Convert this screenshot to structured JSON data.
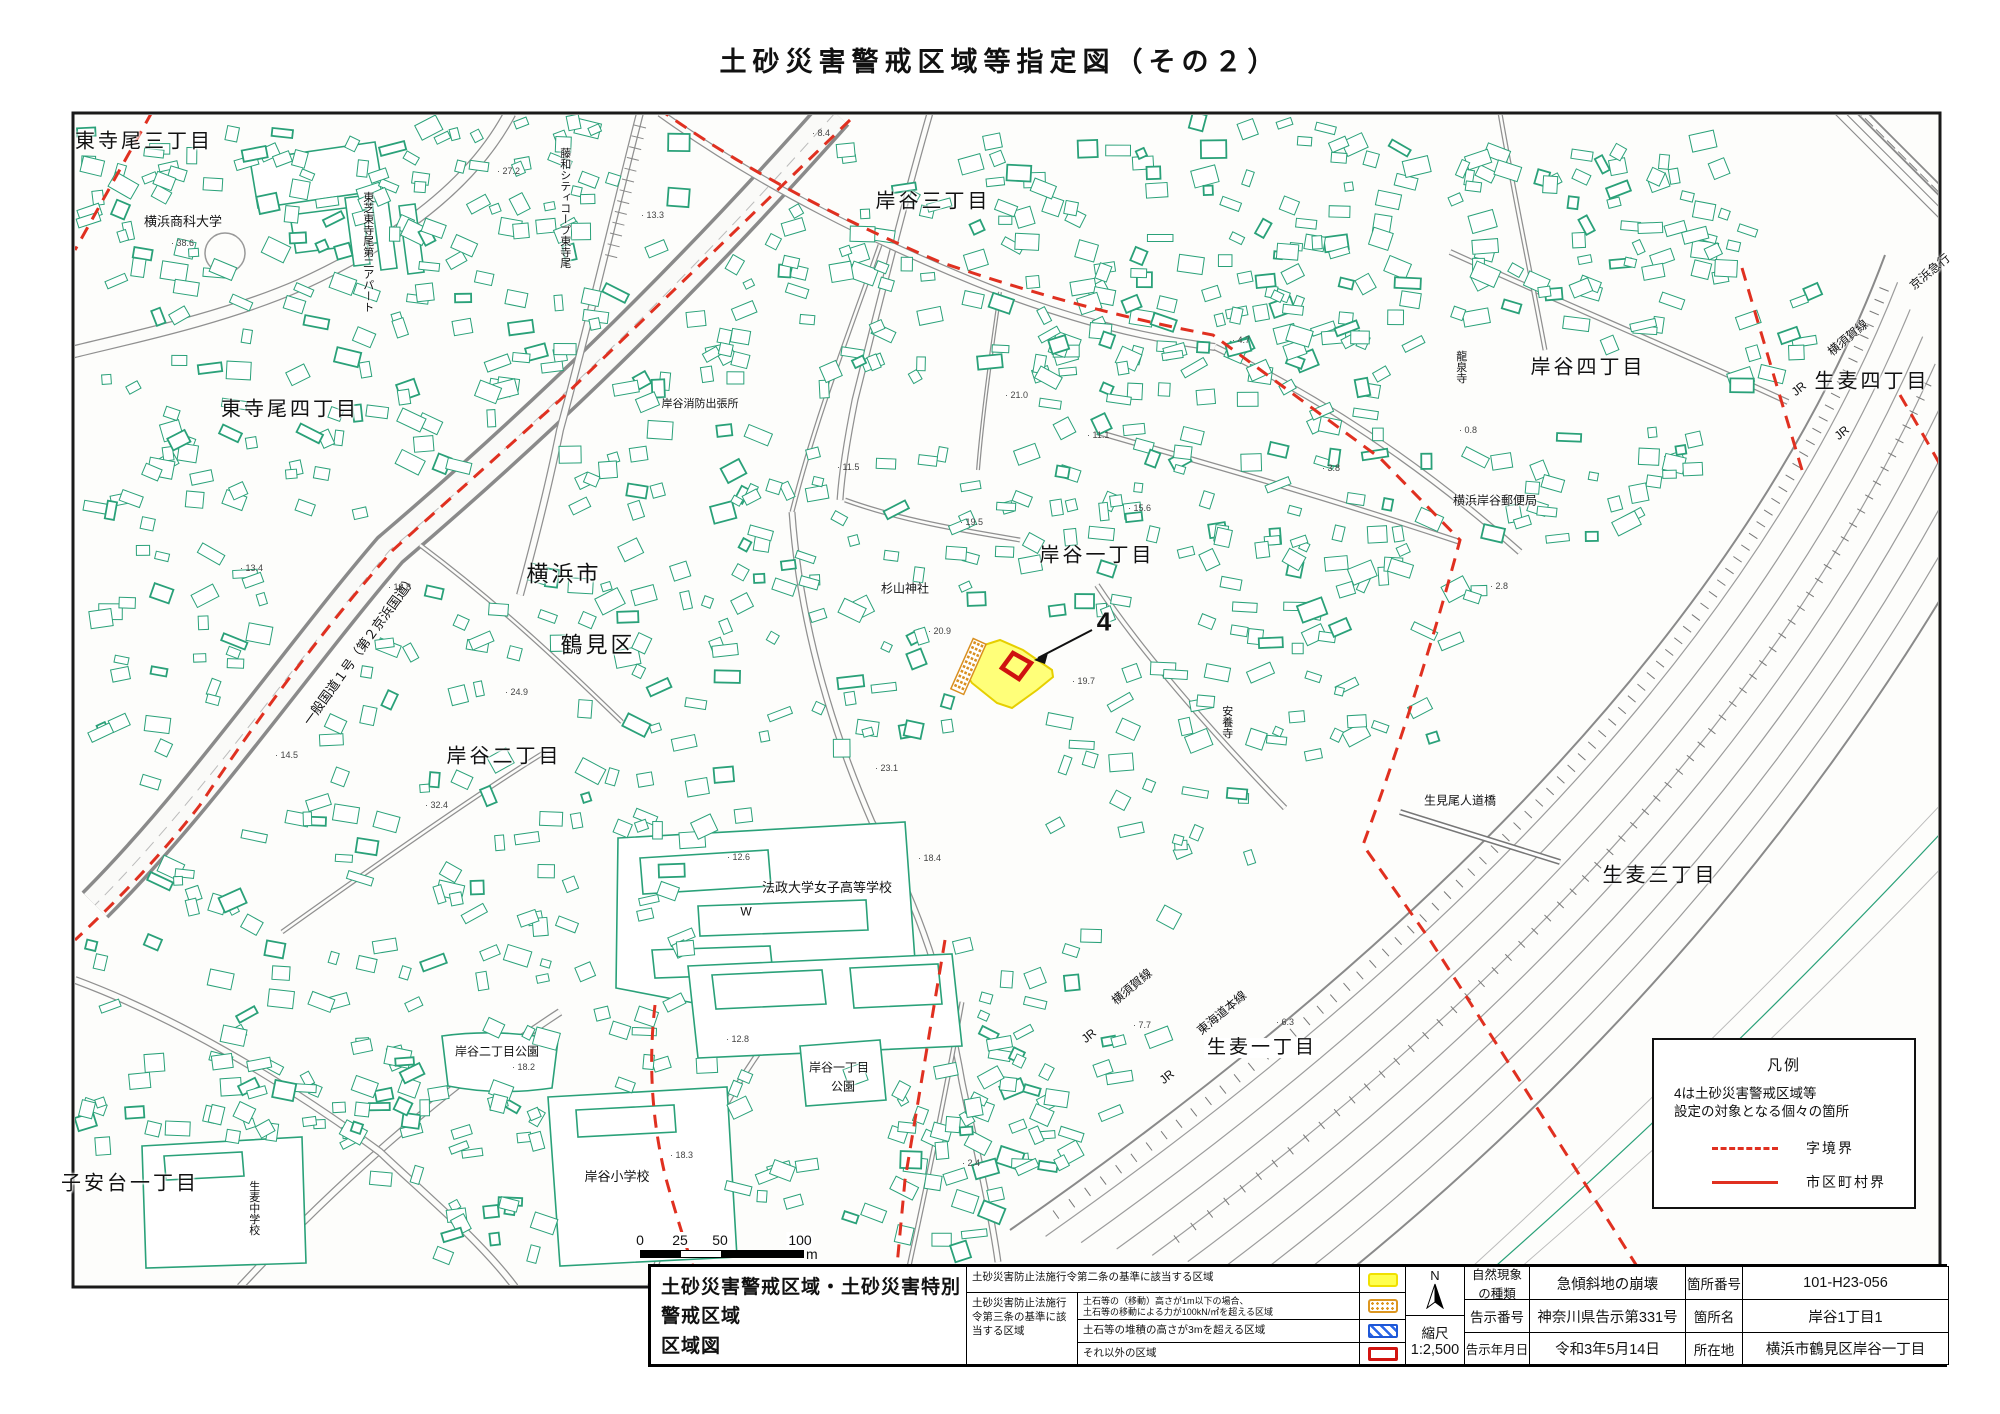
{
  "title": "土砂災害警戒区域等指定図（その２）",
  "legend_box": {
    "title": "凡例",
    "note1": "4は土砂災害警戒区域等",
    "note2": "設定の対象となる個々の箇所",
    "item1": "字境界",
    "item2": "市区町村界"
  },
  "scale_bar": {
    "t0": "0",
    "t1": "25",
    "t2": "50",
    "t3": "100",
    "unit": "m"
  },
  "info_table": {
    "title_line1": "土砂災害警戒区域・土砂災害特別警戒区域",
    "title_line2": "区域図",
    "row1_label": "土砂災害防止法施行令第二条の基準に該当する区域",
    "law3_label": "土砂災害防止法施行令第三条の基準に該当する区域",
    "row2_line1": "土石等の（移動）高さが1m以下の場合、",
    "row2_line2": "土石等の移動による力が100kN/㎡を超える区域",
    "row3_label": "土石等の堆積の高さが3mを超える区域",
    "row4_label": "それ以外の区域",
    "compass": "N",
    "scale_label": "縮尺",
    "scale_value": "1:2,500",
    "h_phenomenon": "自然現象の種類",
    "v_phenomenon": "急傾斜地の崩壊",
    "h_site_no": "箇所番号",
    "v_site_no": "101-H23-056",
    "h_notice_no": "告示番号",
    "v_notice_no": "神奈川県告示第331号",
    "h_site_name": "箇所名",
    "v_site_name": "岸谷1丁目1",
    "h_notice_date": "告示年月日",
    "v_notice_date": "令和3年5月14日",
    "h_location": "所在地",
    "v_location": "横浜市鶴見区岸谷一丁目"
  },
  "map": {
    "marker": {
      "label": "4"
    },
    "labels": [
      {
        "n": "higashiterao-3",
        "t": "東寺尾三丁目",
        "x": 144,
        "y": 142,
        "s": 20,
        "big": true
      },
      {
        "n": "shokadai",
        "t": "横浜商科大学",
        "x": 183,
        "y": 222,
        "s": 13
      },
      {
        "n": "toshiba-apart",
        "t": "東芝東寺尾第二アパート",
        "x": 367,
        "y": 252,
        "s": 11,
        "v": true
      },
      {
        "n": "higashiterao-4",
        "t": "東寺尾四丁目",
        "x": 290,
        "y": 410,
        "s": 20,
        "big": true
      },
      {
        "n": "towa-city-coop",
        "t": "藤和シティコープ東寺尾",
        "x": 564,
        "y": 208,
        "s": 11,
        "v": true
      },
      {
        "n": "kishiya-3",
        "t": "岸谷三丁目",
        "x": 933,
        "y": 202,
        "s": 20,
        "big": true
      },
      {
        "n": "shobo-shutchojo",
        "t": "岸谷消防出張所",
        "x": 700,
        "y": 405,
        "s": 11
      },
      {
        "n": "yokohama-shi",
        "t": "横浜市",
        "x": 564,
        "y": 574,
        "s": 22,
        "big": true
      },
      {
        "n": "tsurumi-ku",
        "t": "鶴見区",
        "x": 598,
        "y": 645,
        "s": 22,
        "big": true
      },
      {
        "n": "kishiya-2",
        "t": "岸谷二丁目",
        "x": 504,
        "y": 757,
        "s": 20,
        "big": true
      },
      {
        "n": "kokudo-1",
        "t": "一般国道１号（第２京浜国道）",
        "x": 360,
        "y": 650,
        "s": 13,
        "r": -54
      },
      {
        "n": "sugiyama-jinja",
        "t": "杉山神社",
        "x": 905,
        "y": 589,
        "s": 12
      },
      {
        "n": "kishiya-1",
        "t": "岸谷一丁目",
        "x": 1097,
        "y": 556,
        "s": 20,
        "big": true
      },
      {
        "n": "anyoji",
        "t": "安養寺",
        "x": 1226,
        "y": 722,
        "s": 11,
        "v": true
      },
      {
        "n": "ryusenji",
        "t": "龍泉寺",
        "x": 1460,
        "y": 367,
        "s": 11,
        "v": true
      },
      {
        "n": "yubinkyoku",
        "t": "横浜岸谷郵便局",
        "x": 1495,
        "y": 501,
        "s": 12
      },
      {
        "n": "kishiya-4",
        "t": "岸谷四丁目",
        "x": 1588,
        "y": 368,
        "s": 20,
        "big": true
      },
      {
        "n": "namamugi-4",
        "t": "生麦四丁目",
        "x": 1872,
        "y": 382,
        "s": 20,
        "big": true
      },
      {
        "n": "yokosuka-line-ne",
        "t": "横須賀線",
        "x": 1848,
        "y": 338,
        "s": 12,
        "r": -40
      },
      {
        "n": "jr-ne-1",
        "t": "JR",
        "x": 1799,
        "y": 389,
        "s": 12,
        "r": -40
      },
      {
        "n": "jr-ne-2",
        "t": "JR",
        "x": 1842,
        "y": 433,
        "s": 12,
        "r": -40
      },
      {
        "n": "keihin-kyuko",
        "t": "京浜急行",
        "x": 1930,
        "y": 272,
        "s": 12,
        "r": -40
      },
      {
        "n": "kishiya2-park",
        "t": "岸谷二丁目公園",
        "x": 497,
        "y": 1052,
        "s": 12
      },
      {
        "n": "kishiya1-park-1",
        "t": "岸谷一丁目",
        "x": 839,
        "y": 1068,
        "s": 12
      },
      {
        "n": "kishiya1-park-2",
        "t": "公園",
        "x": 843,
        "y": 1087,
        "s": 12
      },
      {
        "n": "hosei-school",
        "t": "法政大学女子高等学校",
        "x": 827,
        "y": 888,
        "s": 13
      },
      {
        "n": "w-mark",
        "t": "W",
        "x": 746,
        "y": 912,
        "s": 12
      },
      {
        "n": "kishiya-shogakko",
        "t": "岸谷小学校",
        "x": 617,
        "y": 1177,
        "s": 13
      },
      {
        "n": "namamugi-chugakko",
        "t": "生麦中学校",
        "x": 253,
        "y": 1208,
        "s": 11,
        "v": true
      },
      {
        "n": "koyasudai-1",
        "t": "子安台一丁目",
        "x": 130,
        "y": 1184,
        "s": 20,
        "big": true
      },
      {
        "n": "namamugi-3",
        "t": "生麦三丁目",
        "x": 1660,
        "y": 876,
        "s": 20,
        "big": true
      },
      {
        "n": "namamugi-1",
        "t": "生麦一丁目",
        "x": 1262,
        "y": 1048,
        "s": 19,
        "big": true,
        "bg": true
      },
      {
        "n": "umio-bridge",
        "t": "生見尾人道橋",
        "x": 1460,
        "y": 801,
        "s": 12,
        "bg": true
      },
      {
        "n": "jr-sw-1",
        "t": "JR",
        "x": 1089,
        "y": 1036,
        "s": 12,
        "r": -40
      },
      {
        "n": "yokosuka-line-sw",
        "t": "横須賀線",
        "x": 1132,
        "y": 987,
        "s": 12,
        "r": -40
      },
      {
        "n": "jr-sw-2",
        "t": "JR",
        "x": 1167,
        "y": 1077,
        "s": 12,
        "r": -40
      },
      {
        "n": "tokaido-line",
        "t": "東海道本線",
        "x": 1222,
        "y": 1013,
        "s": 12,
        "r": -40
      }
    ],
    "spots": [
      {
        "t": "38.6",
        "x": 171,
        "y": 243
      },
      {
        "t": "27.2",
        "x": 497,
        "y": 171
      },
      {
        "t": "13.3",
        "x": 641,
        "y": 215
      },
      {
        "t": "8.4",
        "x": 812,
        "y": 133
      },
      {
        "t": "20.9",
        "x": 928,
        "y": 631
      },
      {
        "t": "19.7",
        "x": 1072,
        "y": 681
      },
      {
        "t": "11.5",
        "x": 837,
        "y": 467
      },
      {
        "t": "21.0",
        "x": 1005,
        "y": 395
      },
      {
        "t": "19.5",
        "x": 960,
        "y": 522
      },
      {
        "t": "13.4",
        "x": 240,
        "y": 568
      },
      {
        "t": "12.8",
        "x": 388,
        "y": 587
      },
      {
        "t": "24.9",
        "x": 505,
        "y": 692
      },
      {
        "t": "14.5",
        "x": 275,
        "y": 755
      },
      {
        "t": "32.4",
        "x": 425,
        "y": 805
      },
      {
        "t": "11.1",
        "x": 1087,
        "y": 435
      },
      {
        "t": "15.6",
        "x": 1128,
        "y": 508
      },
      {
        "t": "3.8",
        "x": 1322,
        "y": 468
      },
      {
        "t": "4.7",
        "x": 1232,
        "y": 340
      },
      {
        "t": "0.8",
        "x": 1459,
        "y": 430
      },
      {
        "t": "12.6",
        "x": 727,
        "y": 857
      },
      {
        "t": "18.4",
        "x": 918,
        "y": 858
      },
      {
        "t": "23.1",
        "x": 875,
        "y": 768
      },
      {
        "t": "18.2",
        "x": 512,
        "y": 1067
      },
      {
        "t": "12.8",
        "x": 726,
        "y": 1039
      },
      {
        "t": "18.3",
        "x": 670,
        "y": 1155
      },
      {
        "t": "7.7",
        "x": 1133,
        "y": 1025
      },
      {
        "t": "6.3",
        "x": 1276,
        "y": 1022
      },
      {
        "t": "2.8",
        "x": 1490,
        "y": 586
      },
      {
        "t": "2.4",
        "x": 962,
        "y": 1163
      }
    ]
  }
}
